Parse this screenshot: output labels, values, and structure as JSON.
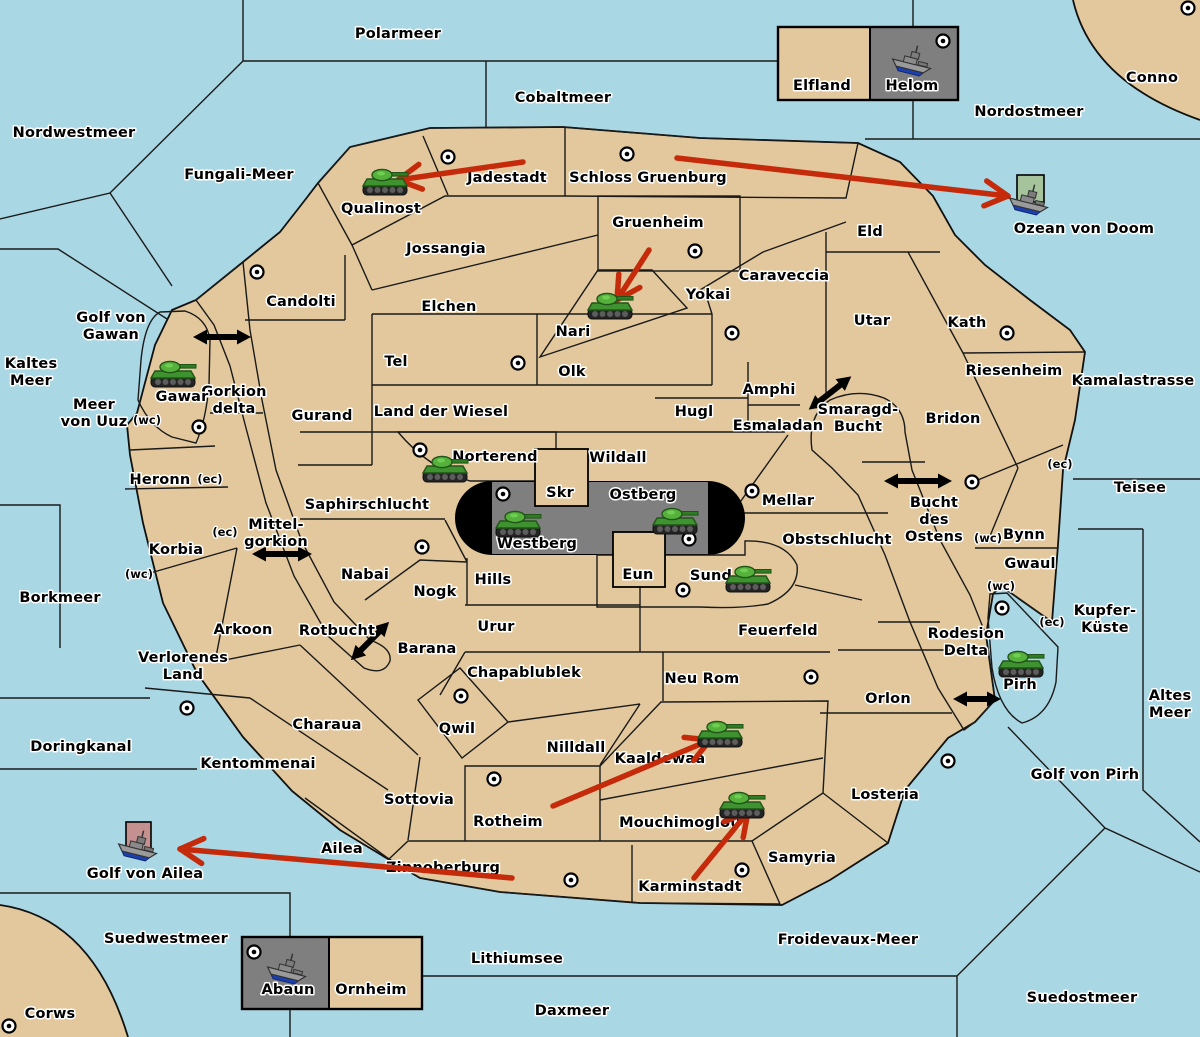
{
  "colors": {
    "water": "#A9D7E4",
    "land": "#E2C89C",
    "green": "#A5C49B",
    "gray": "#7F7F7F",
    "red": "#BE827B",
    "pink_square": "#C59090",
    "black": "#000000",
    "attack_arrow": "#C52A0B",
    "link_arrow": "#000000"
  },
  "territories": [
    {
      "name": "Polarmeer",
      "kind": "sea",
      "x": 398,
      "y": 38
    },
    {
      "name": "Cobaltmeer",
      "kind": "sea",
      "x": 563,
      "y": 102
    },
    {
      "name": "Nordostmeer",
      "kind": "sea",
      "x": 1029,
      "y": 116
    },
    {
      "name": "Nordwestmeer",
      "kind": "sea",
      "x": 74,
      "y": 137
    },
    {
      "name": "Fungali-Meer",
      "kind": "sea",
      "x": 239,
      "y": 179
    },
    {
      "name": "Ozean von Doom",
      "kind": "sea",
      "x": 1084,
      "y": 233
    },
    {
      "name": "Kaltes Meer",
      "kind": "sea",
      "x": 31,
      "y": 368,
      "lines": [
        "Kaltes",
        "Meer"
      ]
    },
    {
      "name": "Golf von Gawan",
      "kind": "sea",
      "x": 111,
      "y": 322,
      "lines": [
        "Golf von",
        "Gawan"
      ]
    },
    {
      "name": "Meer von Uuz",
      "kind": "sea",
      "x": 94,
      "y": 409,
      "lines": [
        "Meer",
        "von Uuz"
      ]
    },
    {
      "name": "Gorkion delta",
      "kind": "sea",
      "x": 234,
      "y": 396,
      "lines": [
        "Gorkion",
        "delta"
      ]
    },
    {
      "name": "Mittelgorkion",
      "kind": "sea",
      "x": 276,
      "y": 529,
      "lines": [
        "Mittel-",
        "gorkion"
      ]
    },
    {
      "name": "Rotbucht",
      "kind": "sea",
      "x": 337,
      "y": 635
    },
    {
      "name": "Borkmeer",
      "kind": "sea",
      "x": 60,
      "y": 602
    },
    {
      "name": "Kamalastrasse",
      "kind": "sea",
      "x": 1133,
      "y": 385
    },
    {
      "name": "Teisee",
      "kind": "sea",
      "x": 1140,
      "y": 492
    },
    {
      "name": "Smaragd-Bucht",
      "kind": "sea",
      "x": 858,
      "y": 414,
      "lines": [
        "Smaragd-",
        "Bucht"
      ]
    },
    {
      "name": "Bucht des Ostens",
      "kind": "sea",
      "x": 934,
      "y": 507,
      "lines": [
        "Bucht",
        "des",
        "Ostens"
      ]
    },
    {
      "name": "Rodesion Delta",
      "kind": "sea",
      "x": 966,
      "y": 638,
      "lines": [
        "Rodesion",
        "Delta"
      ]
    },
    {
      "name": "Kupfer-Küste",
      "kind": "sea",
      "x": 1105,
      "y": 615,
      "lines": [
        "Kupfer-",
        "Küste"
      ]
    },
    {
      "name": "Altes Meer",
      "kind": "sea",
      "x": 1170,
      "y": 700,
      "lines": [
        "Altes",
        "Meer"
      ]
    },
    {
      "name": "Golf von Pirh",
      "kind": "sea",
      "x": 1085,
      "y": 779
    },
    {
      "name": "Doringkanal",
      "kind": "sea",
      "x": 81,
      "y": 751
    },
    {
      "name": "Golf von Ailea",
      "kind": "sea",
      "x": 145,
      "y": 878
    },
    {
      "name": "Suedwestmeer",
      "kind": "sea",
      "x": 166,
      "y": 943
    },
    {
      "name": "Froidevaux-Meer",
      "kind": "sea",
      "x": 848,
      "y": 944
    },
    {
      "name": "Lithiumsee",
      "kind": "sea",
      "x": 517,
      "y": 963
    },
    {
      "name": "Daxmeer",
      "kind": "sea",
      "x": 572,
      "y": 1015
    },
    {
      "name": "Suedostmeer",
      "kind": "sea",
      "x": 1082,
      "y": 1002
    },
    {
      "name": "Corws",
      "kind": "land",
      "x": 50,
      "y": 1018
    },
    {
      "name": "Conno",
      "kind": "land",
      "x": 1152,
      "y": 82
    },
    {
      "name": "Qualinost",
      "kind": "green",
      "x": 381,
      "y": 213
    },
    {
      "name": "Jadestadt",
      "kind": "green",
      "x": 507,
      "y": 182
    },
    {
      "name": "Schloss Gruenburg",
      "kind": "green",
      "x": 648,
      "y": 182
    },
    {
      "name": "Gruenheim",
      "kind": "green",
      "x": 658,
      "y": 227
    },
    {
      "name": "Nari",
      "kind": "green",
      "x": 573,
      "y": 336
    },
    {
      "name": "Jossangia",
      "kind": "land",
      "x": 446,
      "y": 253
    },
    {
      "name": "Eld",
      "kind": "land",
      "x": 870,
      "y": 236
    },
    {
      "name": "Caraveccia",
      "kind": "land",
      "x": 784,
      "y": 280
    },
    {
      "name": "Candolti",
      "kind": "land",
      "x": 301,
      "y": 306
    },
    {
      "name": "Elchen",
      "kind": "land",
      "x": 449,
      "y": 311
    },
    {
      "name": "Yokai",
      "kind": "land",
      "x": 708,
      "y": 299
    },
    {
      "name": "Utar",
      "kind": "land",
      "x": 872,
      "y": 325
    },
    {
      "name": "Kath",
      "kind": "land",
      "x": 967,
      "y": 327
    },
    {
      "name": "Riesenheim",
      "kind": "land",
      "x": 1014,
      "y": 375
    },
    {
      "name": "Tel",
      "kind": "land",
      "x": 396,
      "y": 366
    },
    {
      "name": "Olk",
      "kind": "land",
      "x": 572,
      "y": 376
    },
    {
      "name": "Amphi",
      "kind": "land",
      "x": 769,
      "y": 394
    },
    {
      "name": "Gurand",
      "kind": "land",
      "x": 322,
      "y": 420
    },
    {
      "name": "Land der Wiesel",
      "kind": "land",
      "x": 441,
      "y": 416
    },
    {
      "name": "Hugl",
      "kind": "land",
      "x": 694,
      "y": 416
    },
    {
      "name": "Esmaladan",
      "kind": "land",
      "x": 778,
      "y": 430
    },
    {
      "name": "Bridon",
      "kind": "land",
      "x": 953,
      "y": 423
    },
    {
      "name": "Wildall",
      "kind": "land",
      "x": 618,
      "y": 462
    },
    {
      "name": "Heronn",
      "kind": "land",
      "x": 160,
      "y": 484
    },
    {
      "name": "Saphirschlucht",
      "kind": "land",
      "x": 367,
      "y": 509
    },
    {
      "name": "Skr",
      "kind": "land",
      "x": 560,
      "y": 497
    },
    {
      "name": "Mellar",
      "kind": "land",
      "x": 788,
      "y": 505
    },
    {
      "name": "Korbia",
      "kind": "land",
      "x": 176,
      "y": 554
    },
    {
      "name": "Obstschlucht",
      "kind": "land",
      "x": 837,
      "y": 544
    },
    {
      "name": "Bynn",
      "kind": "land",
      "x": 1024,
      "y": 539
    },
    {
      "name": "Gwaul",
      "kind": "land",
      "x": 1030,
      "y": 568
    },
    {
      "name": "Nabai",
      "kind": "land",
      "x": 365,
      "y": 579
    },
    {
      "name": "Nogk",
      "kind": "land",
      "x": 435,
      "y": 596
    },
    {
      "name": "Hills",
      "kind": "land",
      "x": 493,
      "y": 584
    },
    {
      "name": "Eun",
      "kind": "land",
      "x": 638,
      "y": 579
    },
    {
      "name": "Urur",
      "kind": "land",
      "x": 496,
      "y": 631
    },
    {
      "name": "Feuerfeld",
      "kind": "land",
      "x": 778,
      "y": 635
    },
    {
      "name": "Barana",
      "kind": "land",
      "x": 427,
      "y": 653
    },
    {
      "name": "Arkoon",
      "kind": "land",
      "x": 243,
      "y": 634
    },
    {
      "name": "Verlorenes Land",
      "kind": "land",
      "x": 183,
      "y": 662,
      "lines": [
        "Verlorenes",
        "Land"
      ]
    },
    {
      "name": "Chapablublek",
      "kind": "land",
      "x": 524,
      "y": 677
    },
    {
      "name": "Neu Rom",
      "kind": "land",
      "x": 702,
      "y": 683
    },
    {
      "name": "Orlon",
      "kind": "land",
      "x": 888,
      "y": 703
    },
    {
      "name": "Charaua",
      "kind": "land",
      "x": 327,
      "y": 729
    },
    {
      "name": "Qwil",
      "kind": "land",
      "x": 457,
      "y": 733
    },
    {
      "name": "Nilldall",
      "kind": "land",
      "x": 576,
      "y": 752
    },
    {
      "name": "Kentommenai",
      "kind": "land",
      "x": 258,
      "y": 768
    },
    {
      "name": "Losteria",
      "kind": "land",
      "x": 885,
      "y": 799
    },
    {
      "name": "Sottovia",
      "kind": "land",
      "x": 419,
      "y": 804
    },
    {
      "name": "Samyria",
      "kind": "land",
      "x": 802,
      "y": 862
    },
    {
      "name": "Ailea",
      "kind": "land",
      "x": 342,
      "y": 853
    },
    {
      "name": "Elfland",
      "kind": "land",
      "x": 822,
      "y": 90
    },
    {
      "name": "Ornheim",
      "kind": "land",
      "x": 371,
      "y": 994
    },
    {
      "name": "Gawar",
      "kind": "gray",
      "x": 182,
      "y": 401
    },
    {
      "name": "Norterend",
      "kind": "gray",
      "x": 495,
      "y": 461
    },
    {
      "name": "Westberg",
      "kind": "gray",
      "x": 537,
      "y": 548
    },
    {
      "name": "Ostberg",
      "kind": "gray",
      "x": 643,
      "y": 499
    },
    {
      "name": "Sund",
      "kind": "gray",
      "x": 711,
      "y": 580
    },
    {
      "name": "Pirh",
      "kind": "gray",
      "x": 1020,
      "y": 689
    },
    {
      "name": "Helom",
      "kind": "gray",
      "x": 912,
      "y": 90
    },
    {
      "name": "Abaun",
      "kind": "gray",
      "x": 288,
      "y": 994
    },
    {
      "name": "Rotheim",
      "kind": "red",
      "x": 508,
      "y": 826
    },
    {
      "name": "Kaaldewaa",
      "kind": "red",
      "x": 660,
      "y": 763
    },
    {
      "name": "Mouchimoglou",
      "kind": "red",
      "x": 680,
      "y": 827
    },
    {
      "name": "Zinnoberburg",
      "kind": "red",
      "x": 443,
      "y": 872
    },
    {
      "name": "Karminstadt",
      "kind": "red",
      "x": 690,
      "y": 891
    }
  ],
  "cities": [
    {
      "x": 448,
      "y": 157
    },
    {
      "x": 627,
      "y": 154
    },
    {
      "x": 1188,
      "y": 8
    },
    {
      "x": 943,
      "y": 41
    },
    {
      "x": 695,
      "y": 251
    },
    {
      "x": 257,
      "y": 272
    },
    {
      "x": 732,
      "y": 333
    },
    {
      "x": 1007,
      "y": 333
    },
    {
      "x": 518,
      "y": 363
    },
    {
      "x": 199,
      "y": 427
    },
    {
      "x": 420,
      "y": 450
    },
    {
      "x": 503,
      "y": 494
    },
    {
      "x": 752,
      "y": 491
    },
    {
      "x": 689,
      "y": 539
    },
    {
      "x": 683,
      "y": 590
    },
    {
      "x": 972,
      "y": 482
    },
    {
      "x": 1002,
      "y": 608
    },
    {
      "x": 422,
      "y": 547
    },
    {
      "x": 187,
      "y": 708
    },
    {
      "x": 461,
      "y": 696
    },
    {
      "x": 811,
      "y": 677
    },
    {
      "x": 948,
      "y": 761
    },
    {
      "x": 494,
      "y": 779
    },
    {
      "x": 571,
      "y": 880
    },
    {
      "x": 742,
      "y": 870
    },
    {
      "x": 254,
      "y": 952
    },
    {
      "x": 9,
      "y": 1026
    }
  ],
  "tanks": [
    {
      "territory": "Qualinost",
      "x": 385,
      "y": 183
    },
    {
      "territory": "Gawar",
      "x": 173,
      "y": 375
    },
    {
      "territory": "Nari",
      "x": 610,
      "y": 307
    },
    {
      "territory": "Norterend",
      "x": 445,
      "y": 470
    },
    {
      "territory": "Westberg",
      "x": 518,
      "y": 525
    },
    {
      "territory": "Ostberg",
      "x": 675,
      "y": 522
    },
    {
      "territory": "Sund",
      "x": 748,
      "y": 580
    },
    {
      "territory": "Kaaldewaa",
      "x": 720,
      "y": 735
    },
    {
      "territory": "Mouchimoglou",
      "x": 742,
      "y": 806
    },
    {
      "territory": "Pirh",
      "x": 1021,
      "y": 665
    }
  ],
  "ships": [
    {
      "territory": "Helom",
      "x": 913,
      "y": 60
    },
    {
      "territory": "Ozean von Doom",
      "x": 1030,
      "y": 199
    },
    {
      "territory": "Golf von Ailea",
      "x": 139,
      "y": 845
    },
    {
      "territory": "Abaun",
      "x": 288,
      "y": 968
    }
  ],
  "unit_squares": [
    {
      "x": 1017,
      "y": 175,
      "w": 27,
      "h": 27,
      "color": "#A5C49B"
    },
    {
      "x": 126,
      "y": 822,
      "w": 25,
      "h": 30,
      "color": "#C59090"
    }
  ],
  "attack_arrows": [
    {
      "x1": 523,
      "y1": 162,
      "x2": 398,
      "y2": 180
    },
    {
      "x1": 677,
      "y1": 158,
      "x2": 1008,
      "y2": 196
    },
    {
      "x1": 649,
      "y1": 250,
      "x2": 617,
      "y2": 300
    },
    {
      "x1": 553,
      "y1": 806,
      "x2": 710,
      "y2": 740
    },
    {
      "x1": 694,
      "y1": 878,
      "x2": 748,
      "y2": 812
    },
    {
      "x1": 512,
      "y1": 878,
      "x2": 180,
      "y2": 849
    }
  ],
  "link_arrows": [
    {
      "x": 222,
      "y": 337,
      "angle": 0,
      "len": 58
    },
    {
      "x": 830,
      "y": 393,
      "angle": -38,
      "len": 54
    },
    {
      "x": 918,
      "y": 481,
      "angle": 0,
      "len": 68
    },
    {
      "x": 282,
      "y": 554,
      "angle": 0,
      "len": 60
    },
    {
      "x": 370,
      "y": 641,
      "angle": -45,
      "len": 54
    },
    {
      "x": 977,
      "y": 699,
      "angle": 0,
      "len": 48
    }
  ],
  "coast_markers": [
    {
      "t": "(wc)",
      "x": 147,
      "y": 424
    },
    {
      "t": "(ec)",
      "x": 210,
      "y": 483
    },
    {
      "t": "(ec)",
      "x": 225,
      "y": 536
    },
    {
      "t": "(wc)",
      "x": 139,
      "y": 578
    },
    {
      "t": "(ec)",
      "x": 1060,
      "y": 468
    },
    {
      "t": "(wc)",
      "x": 988,
      "y": 542
    },
    {
      "t": "(wc)",
      "x": 1001,
      "y": 590
    },
    {
      "t": "(ec)",
      "x": 1052,
      "y": 626
    }
  ]
}
